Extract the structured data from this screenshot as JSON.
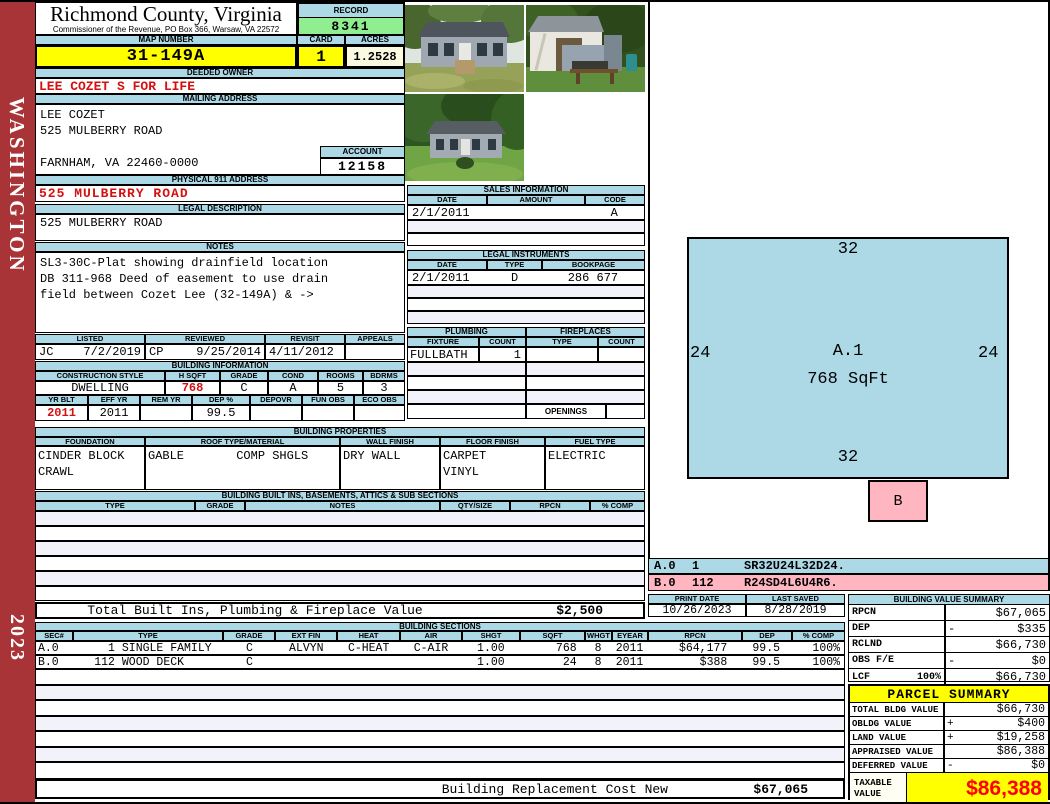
{
  "page": {
    "state_label": "WASHINGTON",
    "year": "2023"
  },
  "header": {
    "title": "Richmond County, Virginia",
    "subtitle": "Commissioner of the Revenue, PO Box 366, Warsaw, VA 22572",
    "record_label": "RECORD",
    "record_value": "8341",
    "map_label": "MAP NUMBER",
    "map_value": "31-149A",
    "card_label": "CARD",
    "card_value": "1",
    "acres_label": "ACRES",
    "acres_value": "1.2528"
  },
  "owner": {
    "deeded_label": "DEEDED OWNER",
    "deeded_value": "LEE COZET  S FOR LIFE",
    "mailing_label": "MAILING ADDRESS",
    "lines": [
      "LEE COZET",
      "525 MULBERRY ROAD",
      "",
      "FARNHAM, VA 22460-0000"
    ],
    "account_label": "ACCOUNT",
    "account_value": "12158",
    "physical_label": "PHYSICAL 911 ADDRESS",
    "physical_value": "525 MULBERRY ROAD",
    "legal_label": "LEGAL DESCRIPTION",
    "legal_value": "525 MULBERRY ROAD"
  },
  "notes": {
    "label": "NOTES",
    "lines": [
      "SL3-30C-Plat showing drainfield location",
      "DB 311-968 Deed of easement to use drain",
      "field between Cozet Lee (32-149A) & ->"
    ]
  },
  "visits": {
    "h": [
      "LISTED",
      "REVIEWED",
      "REVISIT",
      "APPEALS"
    ],
    "listed_by": "JC",
    "listed_date": "7/2/2019",
    "reviewed_by": "CP",
    "reviewed_date": "9/25/2014",
    "revisit_date": "4/11/2012",
    "appeals": ""
  },
  "binfo": {
    "label": "BUILDING INFORMATION",
    "h1": [
      "CONSTRUCTION STYLE",
      "H SQFT",
      "GRADE",
      "COND",
      "ROOMS",
      "BDRMS"
    ],
    "v1": [
      "DWELLING",
      "768",
      "C",
      "A",
      "5",
      "3"
    ],
    "h2": [
      "YR BLT",
      "EFF YR",
      "REM YR",
      "DEP %",
      "DEPOVR",
      "FUN OBS",
      "ECO OBS"
    ],
    "v2": [
      "2011",
      "2011",
      "",
      "99.5",
      "",
      "",
      ""
    ]
  },
  "sales": {
    "label": "SALES INFORMATION",
    "h": [
      "DATE",
      "AMOUNT",
      "CODE"
    ],
    "row1": {
      "date": "2/1/2011",
      "amount": "",
      "code": "A"
    }
  },
  "legal": {
    "label": "LEGAL INSTRUMENTS",
    "h": [
      "DATE",
      "TYPE",
      "BOOKPAGE"
    ],
    "row1": {
      "date": "2/1/2011",
      "type": "D",
      "bookpage": "286 677"
    }
  },
  "plumb": {
    "label": "PLUMBING",
    "h": [
      "FIXTURE",
      "COUNT"
    ],
    "row1": {
      "fixture": "FULLBATH",
      "count": "1"
    }
  },
  "fire": {
    "label": "FIREPLACES",
    "h": [
      "TYPE",
      "COUNT"
    ],
    "openings_label": "OPENINGS",
    "openings_value": ""
  },
  "bprops": {
    "label": "BUILDING PROPERTIES",
    "h": [
      "FOUNDATION",
      "ROOF TYPE/MATERIAL",
      "WALL FINISH",
      "FLOOR FINISH",
      "FUEL TYPE"
    ],
    "foundation": [
      "CINDER BLOCK",
      "CRAWL"
    ],
    "roof_type": "GABLE",
    "roof_material": "COMP SHGLS",
    "wall": "DRY WALL",
    "floor": [
      "CARPET",
      "VINYL"
    ],
    "fuel": "ELECTRIC"
  },
  "builtins": {
    "label": "BUILDING BUILT INS, BASEMENTS, ATTICS & SUB SECTIONS",
    "h": [
      "TYPE",
      "GRADE",
      "NOTES",
      "QTY/SIZE",
      "RPCN",
      "% COMP"
    ]
  },
  "totals": {
    "built_label": "Total Built Ins, Plumbing & Fireplace Value",
    "built_value": "$2,500",
    "repl_label": "Building Replacement Cost New",
    "repl_value": "$67,065"
  },
  "bsec": {
    "label": "BUILDING SECTIONS",
    "h": [
      "SEC#",
      "TYPE",
      "GRADE",
      "EXT FIN",
      "HEAT",
      "AIR",
      "SHGT",
      "SQFT",
      "WHGT",
      "EYEAR",
      "RPCN",
      "DEP",
      "% COMP"
    ],
    "rows": [
      {
        "sec": "A.0",
        "type_num": "1",
        "type_name": "SINGLE FAMILY",
        "grade": "C",
        "extfin": "ALVYN",
        "heat": "C-HEAT",
        "air": "C-AIR",
        "shgt": "1.00",
        "sqft": "768",
        "whgt": "8",
        "eyear": "2011",
        "rpcn": "$64,177",
        "dep": "99.5",
        "comp": "100%"
      },
      {
        "sec": "B.0",
        "type_num": "112",
        "type_name": "WOOD DECK",
        "grade": "C",
        "extfin": "",
        "heat": "",
        "air": "",
        "shgt": "1.00",
        "sqft": "24",
        "whgt": "8",
        "eyear": "2011",
        "rpcn": "$388",
        "dep": "99.5",
        "comp": "100%"
      }
    ]
  },
  "sketch": {
    "dim_top": "32",
    "dim_left": "24",
    "dim_right": "24",
    "dim_bottom": "32",
    "area_label": "A.1",
    "area_sqft": "768 SqFt",
    "b_label": "B",
    "codes": [
      {
        "sec": "A.0",
        "qty": "1",
        "path": "SR32U24L32D24."
      },
      {
        "sec": "B.0",
        "qty": "112",
        "path": "R24SD4L6U4R6."
      }
    ]
  },
  "printinfo": {
    "pd_label": "PRINT DATE",
    "pd_value": "10/26/2023",
    "ls_label": "LAST SAVED",
    "ls_value": "8/28/2019"
  },
  "bvs": {
    "label": "BUILDING VALUE SUMMARY",
    "rows": [
      {
        "label": "RPCN",
        "pct": "",
        "sign": "",
        "value": "$67,065"
      },
      {
        "label": "DEP",
        "pct": "",
        "sign": "-",
        "value": "$335"
      },
      {
        "label": "RCLND",
        "pct": "",
        "sign": "",
        "value": "$66,730"
      },
      {
        "label": "OBS F/E",
        "pct": "",
        "sign": "-",
        "value": "$0"
      },
      {
        "label": "LCF",
        "pct": "100%",
        "sign": "",
        "value": "$66,730"
      }
    ]
  },
  "parcel": {
    "label": "PARCEL SUMMARY",
    "rows": [
      {
        "label": "TOTAL BLDG VALUE",
        "sign": "",
        "value": "$66,730"
      },
      {
        "label": "OBLDG VALUE",
        "sign": "+",
        "value": "$400"
      },
      {
        "label": "LAND VALUE",
        "sign": "+",
        "value": "$19,258"
      },
      {
        "label": "APPRAISED VALUE",
        "sign": "",
        "value": "$86,388"
      },
      {
        "label": "DEFERRED VALUE",
        "sign": "-",
        "value": "$0"
      }
    ],
    "tax_label1": "TAXABLE",
    "tax_label2": "VALUE",
    "tax_value": "$86,388"
  }
}
